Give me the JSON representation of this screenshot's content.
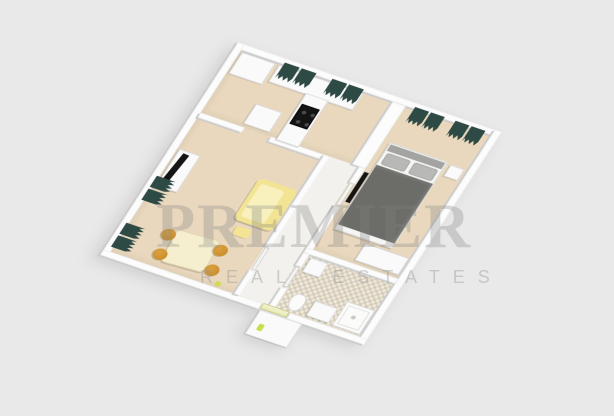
{
  "watermark": {
    "title": "PREMIER",
    "subtitle": "REAL ESTATES"
  },
  "scene": {
    "type": "3d-floor-plan-render",
    "rooms": [
      "kitchen",
      "living-room",
      "hallway",
      "bedroom",
      "bathroom"
    ],
    "furniture": [
      "kitchen-counter",
      "cooktop",
      "wardrobe",
      "small-table",
      "tv",
      "tv-stand",
      "sofa",
      "ottoman",
      "dining-table",
      "stools",
      "window-curtains",
      "bed",
      "pillows",
      "nightstand",
      "bathroom-shower",
      "toilet",
      "vanity",
      "washer",
      "entry-landing"
    ]
  },
  "palette": {
    "background": "#e9e9e9",
    "wall": "#fcfcfc",
    "wall_shadow": "#cbcbcb",
    "floor": "#e9d8bd",
    "corridor_floor": "#f2f1ed",
    "tile": "#efe9dc",
    "curtain": "#2e4a45",
    "sofa": "#f2e492",
    "sofa_seat": "#f8f1bd",
    "table": "#f6efcf",
    "chair": "#c78a26",
    "bed_duvet": "#6c6c68",
    "bed_pillow": "#b8b8b6",
    "bed_base": "#f5f5f3",
    "appliance_dark": "#141414",
    "accent_lime": "#cbdc4e",
    "watermark": "rgba(128,128,128,0.30)",
    "watermark_sub": "rgba(150,150,150,0.42)"
  }
}
